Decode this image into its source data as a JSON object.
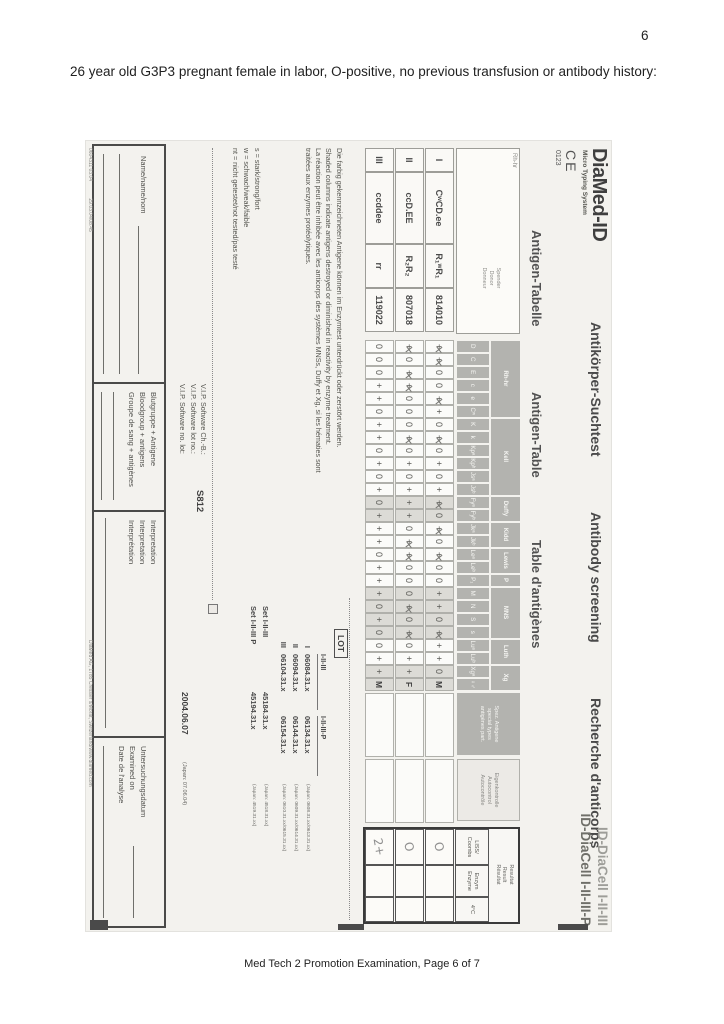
{
  "page": {
    "number": "6",
    "heading": "26 year old G3P3 pregnant female in labor, O-positive, no previous transfusion or antibody history:",
    "footer": "Med Tech 2 Promotion Examination, Page 6 of 7"
  },
  "form": {
    "brand": {
      "logo": "DiaMed-ID",
      "tagline": "Micro Typing System",
      "ce": "CE",
      "ce_number": "0123"
    },
    "titles": {
      "row1": [
        "Antikörper-Suchtest",
        "Antibody screening",
        "Recherche d'anticorps"
      ],
      "row2": [
        "Antigen-Tabelle",
        "Antigen-Table",
        "Table d'antigènes"
      ],
      "product1": "ID-DiaCell I-II-III",
      "product2": "ID-DiaCell I-II-III-P"
    },
    "table": {
      "rh_label": "Rh-hr",
      "donor_label": [
        "Spender",
        "Donor",
        "Donneur"
      ],
      "groups": [
        {
          "name": "Rh-hr",
          "cols": [
            "D",
            "C",
            "E",
            "c",
            "e",
            "Cʷ"
          ]
        },
        {
          "name": "Kell",
          "cols": [
            "K",
            "k",
            "Kpᵃ",
            "Kpᵇ",
            "Jsᵃ",
            "Jsᵇ"
          ]
        },
        {
          "name": "Duffy",
          "cols": [
            "Fyᵃ",
            "Fyᵇ"
          ]
        },
        {
          "name": "Kidd",
          "cols": [
            "Jkᵃ",
            "Jkᵇ"
          ]
        },
        {
          "name": "Lewis",
          "cols": [
            "Leᵃ",
            "Leᵇ"
          ]
        },
        {
          "name": "P",
          "cols": [
            "P₁"
          ]
        },
        {
          "name": "MNS",
          "cols": [
            "M",
            "N",
            "S",
            "s"
          ]
        },
        {
          "name": "Luth",
          "cols": [
            "Luᵃ",
            "Luᵇ"
          ]
        },
        {
          "name": "Xg",
          "cols": [
            "Xgᵃ",
            "♀♂"
          ]
        }
      ],
      "shaded_cols": [
        12,
        13,
        19,
        20,
        21,
        22,
        25,
        26
      ],
      "special_header": [
        "Spez. Antigene",
        "special types",
        "antigènes part."
      ],
      "autocontrol_header": [
        "Eigenkontrolle",
        "Autocontrol",
        "Autocontrôle"
      ],
      "results_header": [
        "Resultat",
        "Result",
        "Résultat"
      ],
      "results_cols": [
        [
          "LISS/",
          "Coombs"
        ],
        [
          "Enzym",
          "Enzyme"
        ],
        [
          "4°C"
        ]
      ],
      "rows": [
        {
          "id": "I",
          "phenotype": "CʷCD.ee",
          "rh": "R₁ʷR₁",
          "donor": "814010",
          "antigens": [
            "x",
            "x",
            "0",
            "0",
            "x",
            "+",
            "0",
            "x",
            "0",
            "+",
            "0",
            "+",
            "x",
            "0",
            "x",
            "0",
            "x",
            "0",
            "0",
            "+",
            "+",
            "0",
            "x",
            "+",
            "+",
            "0"
          ],
          "sex": "M",
          "results": {
            "liss": "O",
            "enzym": "",
            "cold": ""
          }
        },
        {
          "id": "II",
          "phenotype": "ccD.EE",
          "rh": "R₂R₂",
          "donor": "807018",
          "antigens": [
            "x",
            "0",
            "x",
            "x",
            "0",
            "0",
            "0",
            "x",
            "0",
            "+",
            "0",
            "+",
            "+",
            "+",
            "0",
            "x",
            "x",
            "0",
            "0",
            "0",
            "x",
            "0",
            "x",
            "0",
            "+",
            "+"
          ],
          "sex": "F",
          "results": {
            "liss": "O",
            "enzym": "",
            "cold": ""
          }
        },
        {
          "id": "III",
          "phenotype": "ccddee",
          "rh": "rr",
          "donor": "119022",
          "antigens": [
            "0",
            "0",
            "0",
            "+",
            "+",
            "0",
            "+",
            "+",
            "0",
            "+",
            "0",
            "+",
            "0",
            "+",
            "+",
            "+",
            "0",
            "+",
            "+",
            "+",
            "0",
            "+",
            "0",
            "0",
            "+",
            "+"
          ],
          "sex": "M",
          "results": {
            "liss": "2+",
            "enzym": "",
            "cold": ""
          }
        }
      ]
    },
    "notes": {
      "de": "Die farbig gekennzeichneten Antigene können im Enzymtest unterdrückt oder zerstört werden.",
      "en": "Shaded columns indicate antigens destroyed or diminished in reactivity by enzyme treatment.",
      "fr": "La réaction peut être inhibée avec les anticorps des systèmes MNSs, Duffy et Xg, si les hématies sont traitées aux enzymes protéolytiques.",
      "legend": [
        "s  =  stark/strong/fort",
        "w  =  schwach/weak/faible",
        "nt =  nicht getestet/not tested/pas testé"
      ]
    },
    "vip": {
      "lines": [
        "V.I.P. Software Ch.-B.:",
        "V.I.P. Software lot no.:",
        "V.I.P. Software no. lot:"
      ],
      "value": "S812"
    },
    "lot": {
      "label": "LOT",
      "col1": "I-II-III",
      "col2": "I-II-III-P",
      "rows": [
        {
          "id": "I",
          "a": "06084.31.x",
          "b": "06134.31.x",
          "jp": "(Japan: 0608.31.xx/0613.31.xx)"
        },
        {
          "id": "II",
          "a": "06094.31.x",
          "b": "06144.31.x",
          "jp": "(Japan: 0609.31.xx/0614.31.xx)"
        },
        {
          "id": "III",
          "a": "06104.31.x",
          "b": "06154.31.x",
          "jp": "(Japan: 0610.31.xx/0615.31.xx)"
        }
      ],
      "sets": [
        {
          "label": "Set I-II-III",
          "value": "45184.31.x",
          "jp": "(Japan: 4518.31.xx)"
        },
        {
          "label": "Set I-II-III P",
          "value": "45194.31.x",
          "jp": "(Japan: 4519.31.xx)"
        }
      ],
      "expiry": "2004.06.07",
      "expiry_jp": "(Japan: 07.06.04)"
    },
    "fields": {
      "name": [
        "Name/name/nom"
      ],
      "bloodgroup": [
        "Blutgruppe + Antigene",
        "Bloodgroup + antigens",
        "Groupe de sang + antigènes"
      ],
      "interpretation": [
        "Interpretation",
        "Interpretation",
        "Interprétation"
      ],
      "examined": [
        "Untersuchungsdatum",
        "Examined on",
        "Date de l'analyse"
      ]
    },
    "footer_codes": [
      "0604311   03.04",
      "29.03.04/08.45"
    ],
    "address": "DiaMed AG, 1785 Cressier s/Morat, Switzerland/www.diamed.com"
  },
  "colors": {
    "header_gray": "#b3b3af",
    "shaded_cell": "#dcdbd6",
    "pencil": "#8f8f8f",
    "form_bg": "#f3f2ee"
  }
}
